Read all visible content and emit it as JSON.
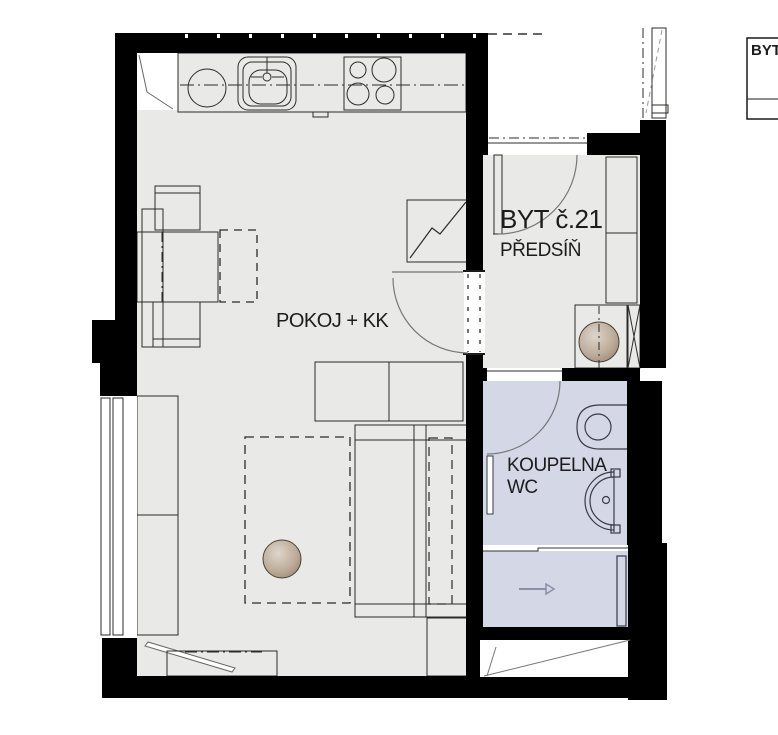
{
  "plan": {
    "title": "Apartment floor plan",
    "apartment_label": "BYT č.21",
    "legend_box": {
      "label": "BYT"
    },
    "rooms": [
      {
        "id": "pokoj",
        "label": "POKOJ + KK"
      },
      {
        "id": "predsin",
        "label": "PŘEDSÍŇ"
      },
      {
        "id": "koupelna",
        "label": "KOUPELNA",
        "label2": "WC"
      }
    ],
    "fixtures": [
      "kitchen-counter",
      "kitchen-sink",
      "cooktop-4-burners",
      "counter-appliance-circle",
      "fridge-niche",
      "dining-table",
      "chairs",
      "tv-unit",
      "sideboard",
      "bed",
      "armchair",
      "rug",
      "round-table",
      "shelving-units",
      "window-left",
      "window-top-right",
      "entrance-door",
      "interior-door-opening",
      "bathroom-door",
      "toilet",
      "washbasin",
      "towel-radiator",
      "wardrobe",
      "washing-machine",
      "installation-shaft",
      "direction-arrow",
      "radiator-diagonal"
    ],
    "colors": {
      "wall": "#000000",
      "floor": "#e9e9e8",
      "bathroom_floor": "#d4d7e6",
      "furniture_light": "#d8d1c7",
      "furniture_mid": "#bfb3a4",
      "furniture_dark": "#95887a",
      "counter_dark": "#a99c8e",
      "outline": "#2b2b28",
      "door_arc": "#777777",
      "arrow": "#8a90a6",
      "background": "#ffffff"
    }
  }
}
